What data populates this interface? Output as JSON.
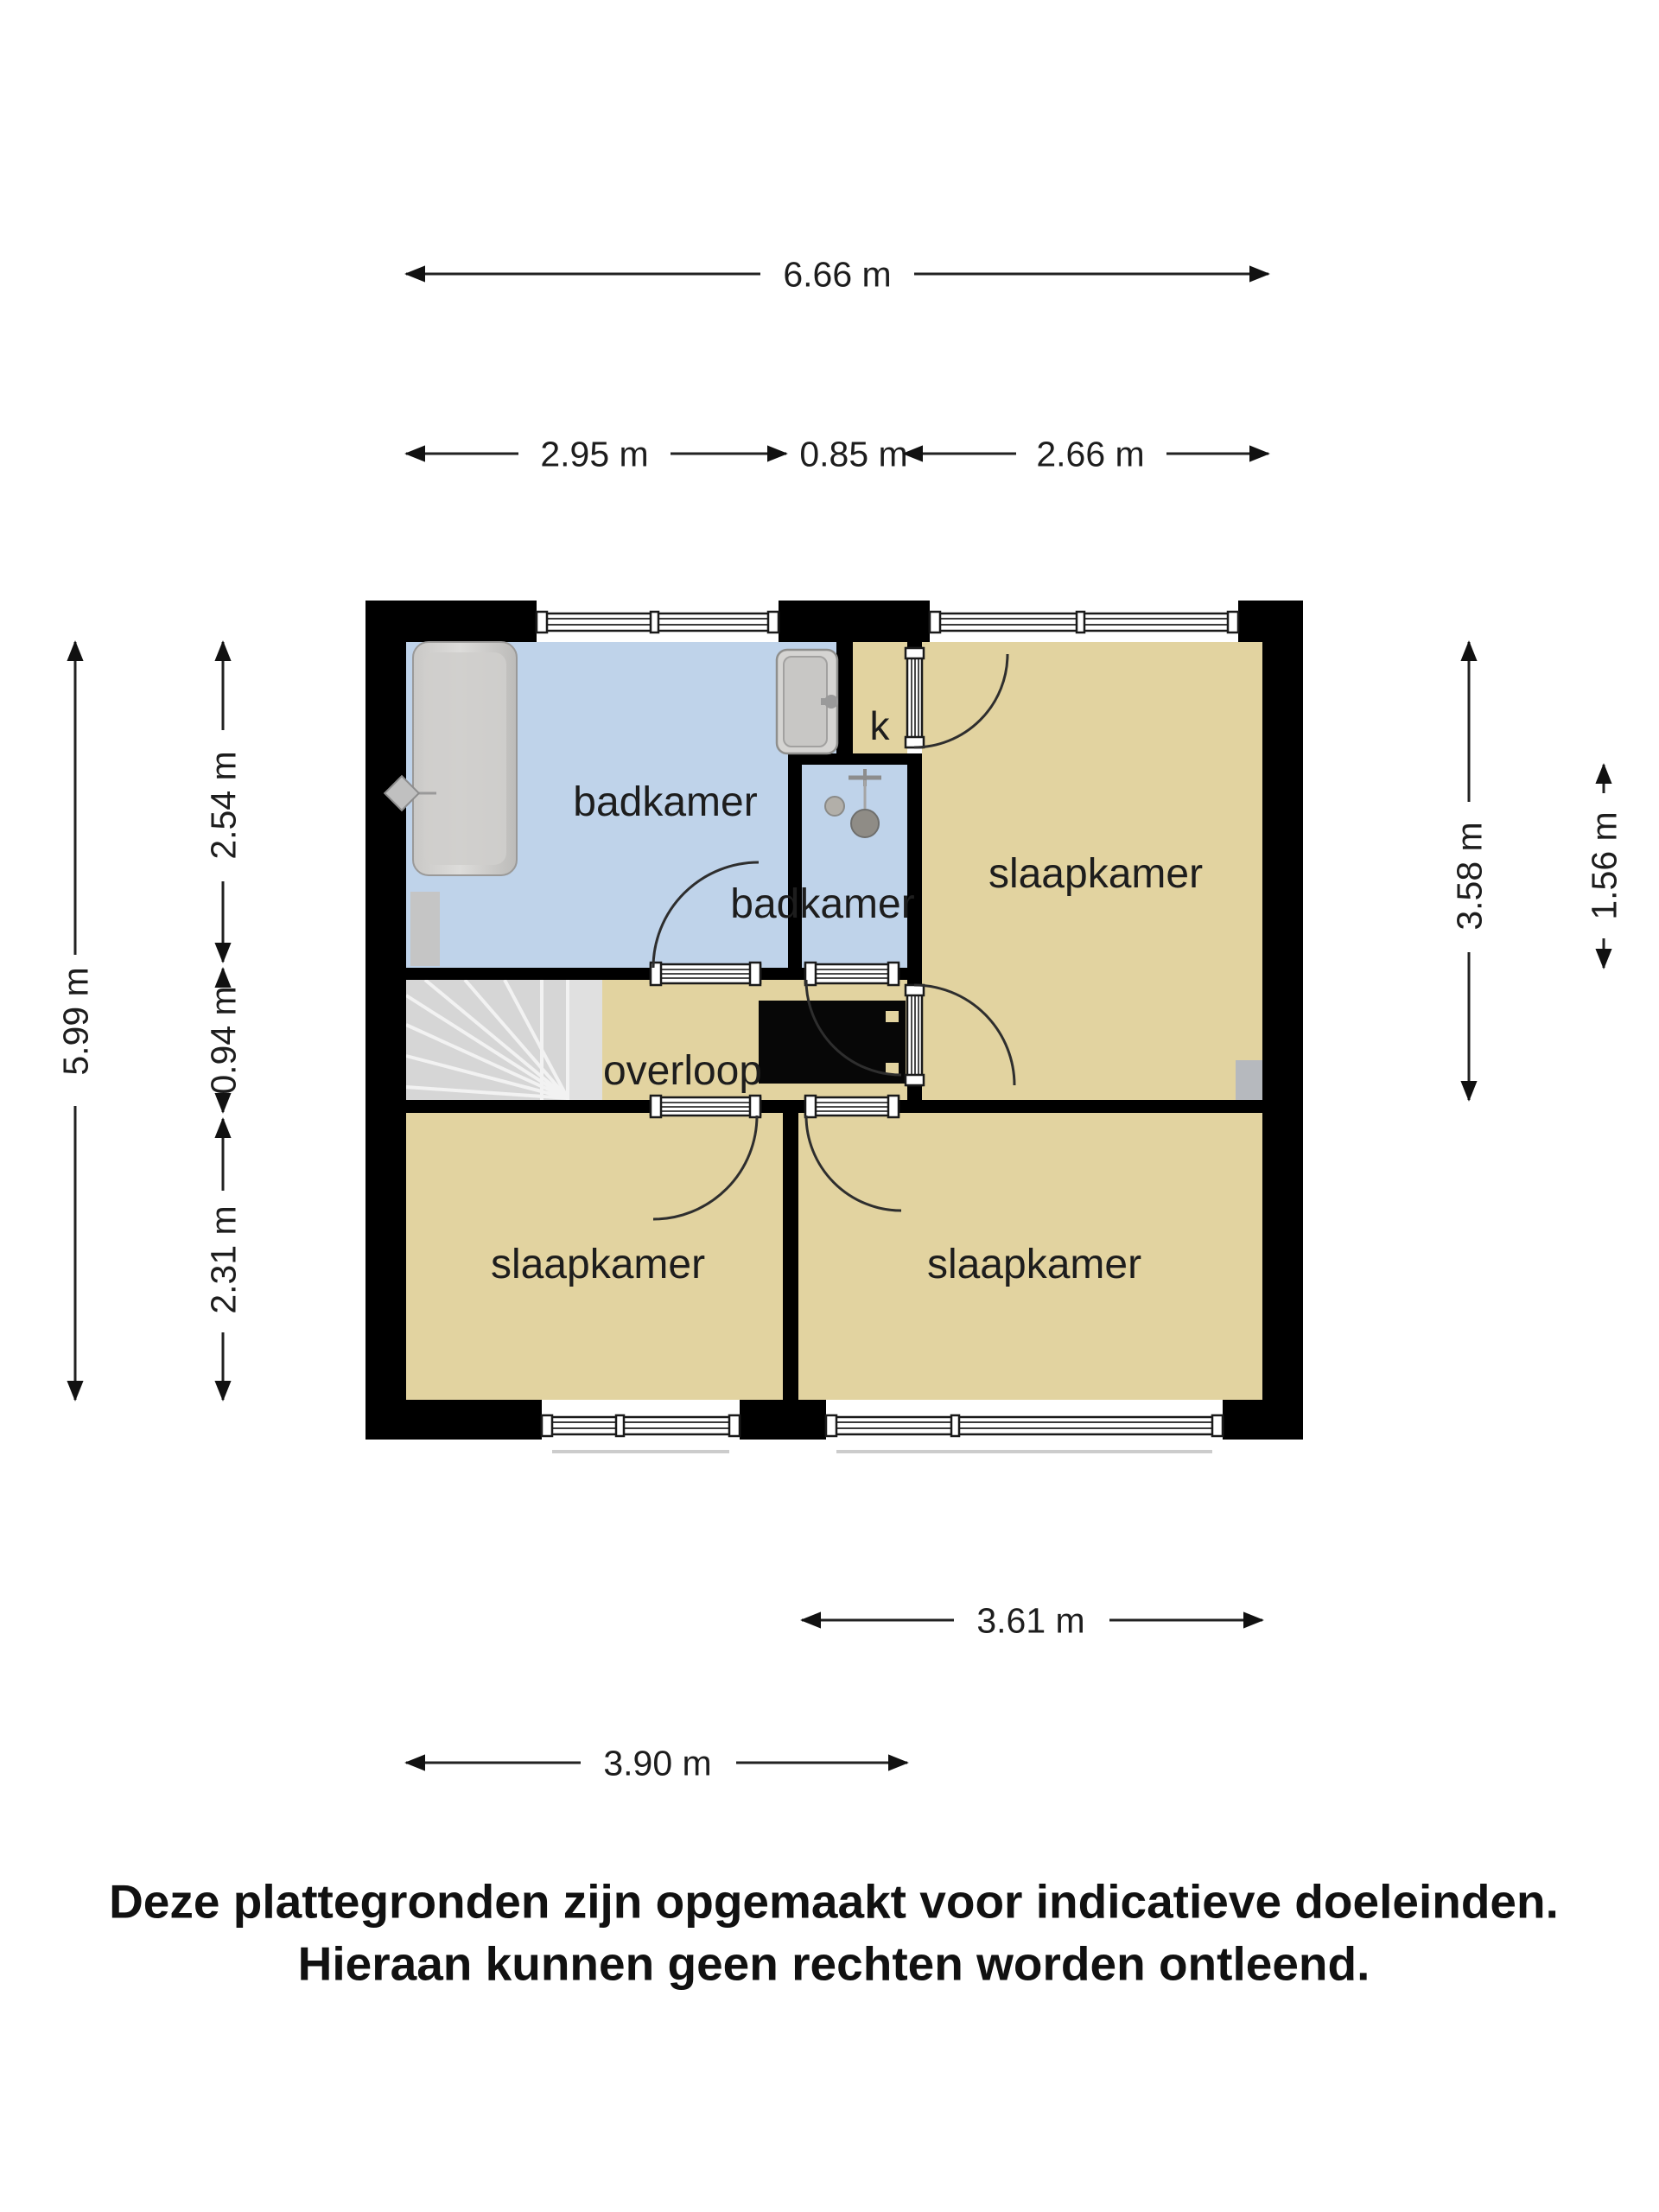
{
  "page": {
    "type": "floorplan",
    "background": "#ffffff"
  },
  "rooms": {
    "badkamer_main": "badkamer",
    "closet": "k",
    "slaapkamer_tr": "slaapkamer",
    "badkamer_small": "badkamer",
    "overloop": "overloop",
    "slaapkamer_bl": "slaapkamer",
    "slaapkamer_br": "slaapkamer"
  },
  "dimensions": {
    "top_total": "6.66 m",
    "top_left": "2.95 m",
    "top_mid": "0.85 m",
    "top_right": "2.66 m",
    "left_total": "5.99 m",
    "left_top": "2.54 m",
    "left_mid": "0.94 m",
    "left_bottom": "2.31 m",
    "right_tall": "3.58 m",
    "right_short": "1.56 m",
    "bottom_upper": "3.61 m",
    "bottom_lower": "3.90 m"
  },
  "fixtures": {
    "bathtub": "bathtub-icon",
    "shower": "shower-head-icon",
    "washbasin": "washbasin-icon",
    "toilet": "toilet-icon",
    "stairs": "stairs-icon",
    "stairwell_void": "stairwell-void"
  },
  "disclaimer": {
    "line1": "Deze plattegronden zijn opgemaakt voor indicatieve doeleinden.",
    "line2": "Hieraan kunnen geen rechten worden ontleend."
  },
  "colors": {
    "floor_room": "#e2d3a0",
    "floor_bath": "#bfd3ea",
    "wall": "#000000",
    "stairs": "#d6d6d6",
    "dimension": "#222222"
  }
}
